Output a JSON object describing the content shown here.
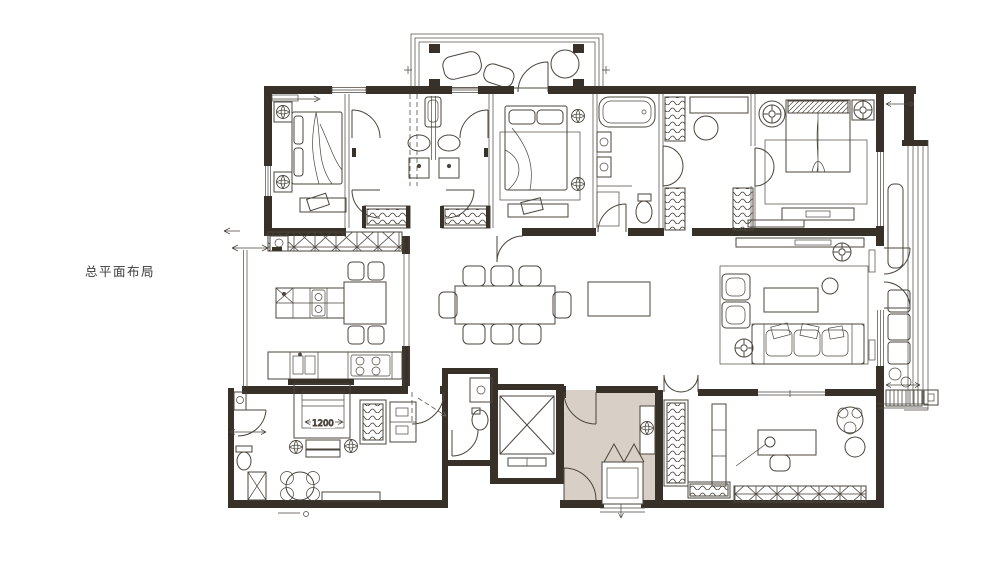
{
  "page": {
    "background": "#ffffff"
  },
  "floorplan": {
    "title": "总平面布局",
    "bed_dimension": "1200",
    "colors": {
      "wall_fill": "#37312a",
      "line": "#4b453d",
      "foyer_fill": "#d8cfc6",
      "paper": "#ffffff"
    }
  }
}
